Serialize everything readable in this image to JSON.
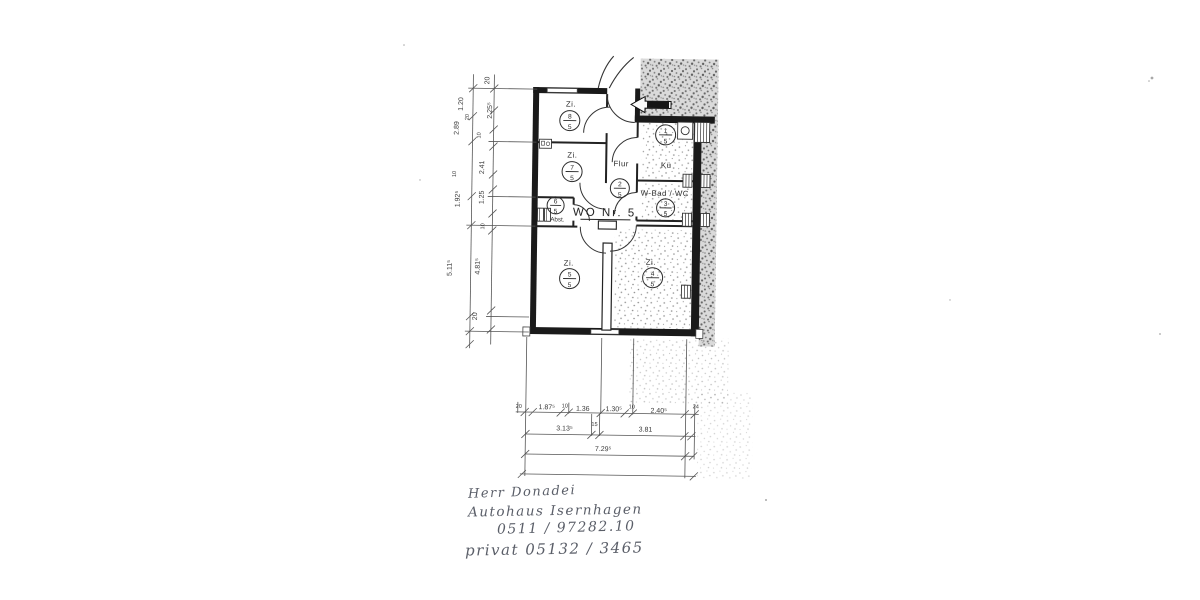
{
  "plan": {
    "apartment_label": "WO Nr. 5",
    "rooms": [
      {
        "label": "Zi.",
        "num": "8",
        "den": "5"
      },
      {
        "label": "Zi.",
        "num": "7",
        "den": "5"
      },
      {
        "label": "Flur",
        "num": "2",
        "den": "5"
      },
      {
        "label": "Kü",
        "num": "1",
        "den": "5"
      },
      {
        "label": "W-Bad / WC",
        "num": "3",
        "den": "5"
      },
      {
        "label": "Abst.",
        "num": "6",
        "den": "5"
      },
      {
        "label": "Zi.",
        "num": "5",
        "den": "5"
      },
      {
        "label": "Zi.",
        "num": "4",
        "den": "5"
      }
    ]
  },
  "dimensions": {
    "left_chain": [
      "20",
      "1.20",
      "2.25⁵",
      "2.89",
      "20",
      "10",
      "2.41",
      "10",
      "1.92⁵",
      "1.25",
      "10",
      "5.11⁵",
      "4.81⁵",
      "20"
    ],
    "bottom_row1": [
      "20",
      "1.87⁵",
      "10",
      "1.36",
      "1.30⁵",
      "10",
      "2.40⁵",
      "24"
    ],
    "bottom_row2": [
      "3.13⁵",
      "15",
      "3.81"
    ],
    "bottom_row3": [
      "7.29⁵"
    ]
  },
  "handwriting": {
    "line1": "Herr Donadei",
    "line2": "Autohaus Isernhagen",
    "line3": "0511 / 97282.10",
    "line4": "privat 05132 / 3465"
  },
  "colors": {
    "ink": "#1a1a1a",
    "dim_text": "#3a3a3a",
    "pencil": "#5a5e68",
    "speckle": "#8f8f8f"
  }
}
